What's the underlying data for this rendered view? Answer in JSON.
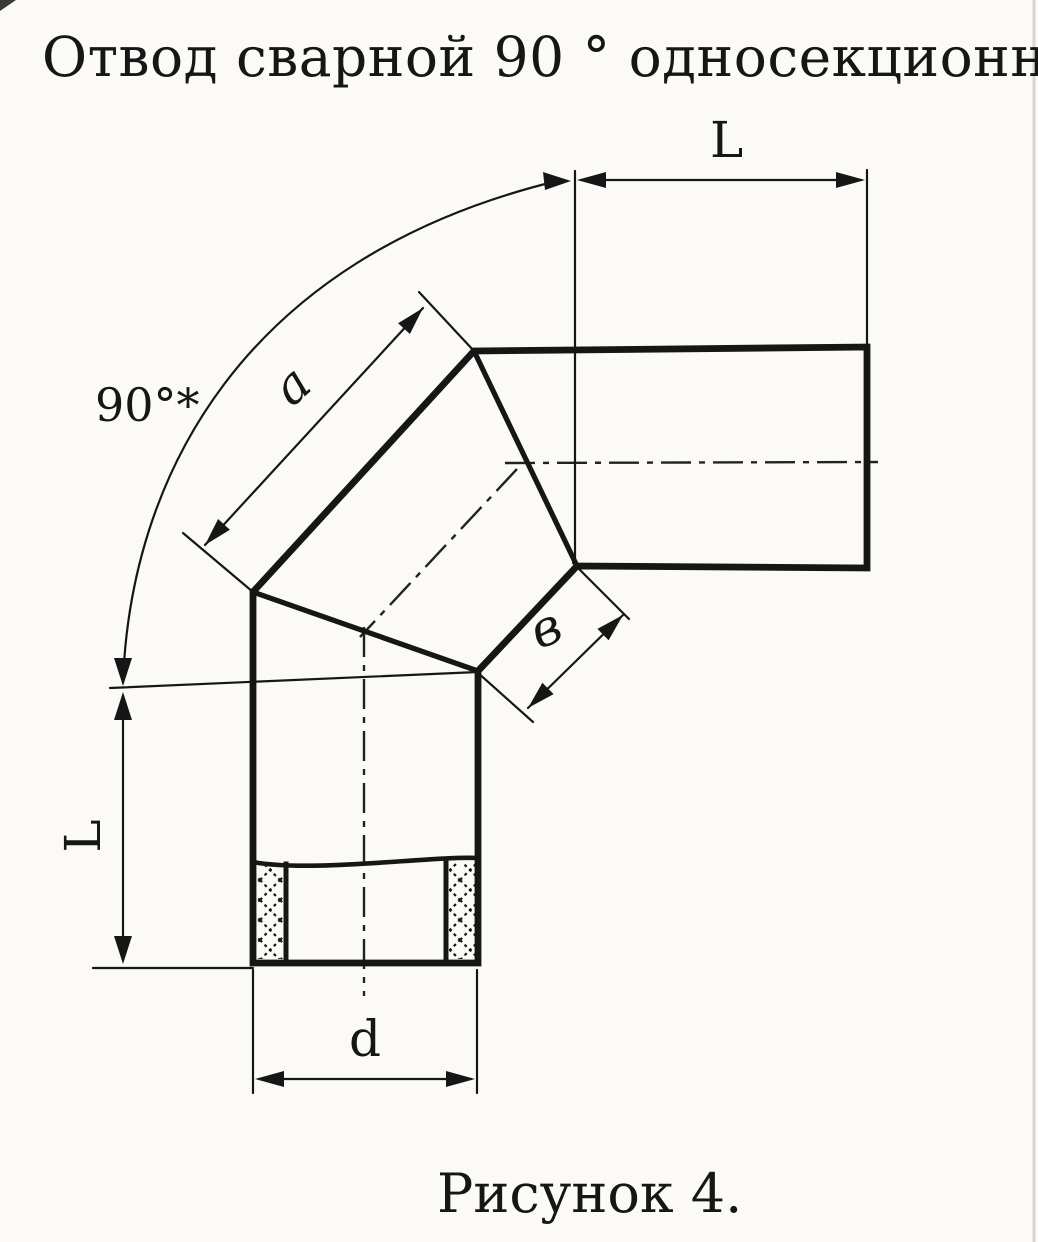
{
  "page": {
    "title": "Отвод сварной 90 ° односекционный",
    "caption": "Рисунок 4."
  },
  "dimensions": {
    "angle_label": "90°*",
    "top_leg_length_label": "L",
    "left_leg_length_label": "L",
    "section_outer_side_label": "a",
    "section_inner_side_label": "в",
    "diameter_label": "d"
  },
  "colors": {
    "ink": "#161616",
    "paper": "#fbfaf6",
    "scan_edge": "#d9d7d2"
  }
}
